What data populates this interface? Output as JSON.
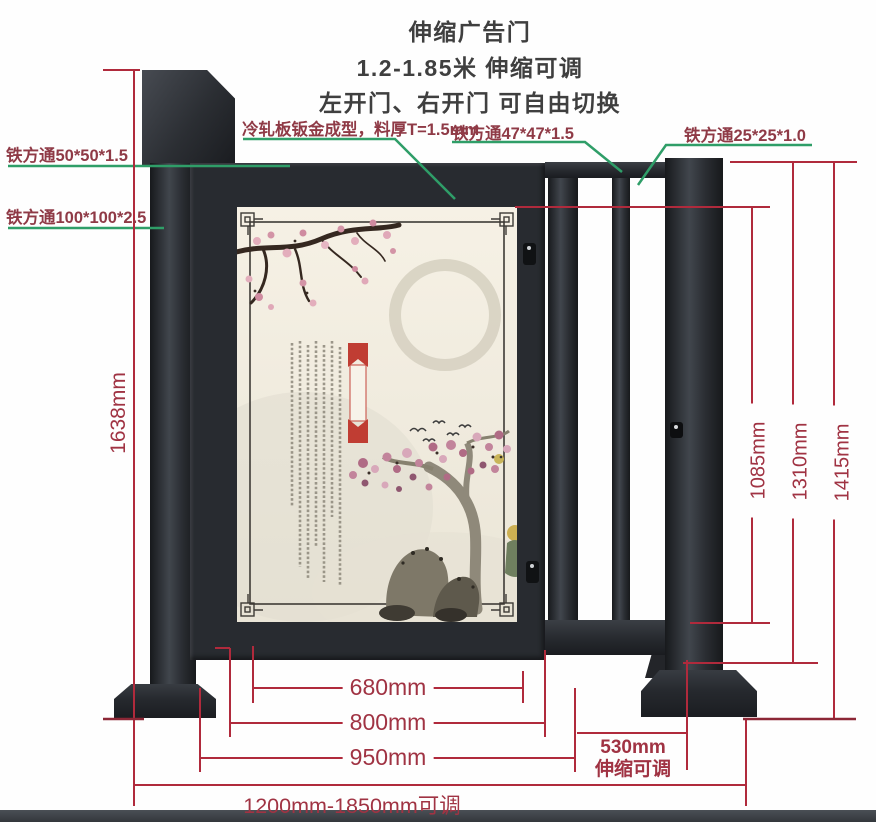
{
  "title": {
    "line1": "伸缩广告门",
    "line2": "1.2-1.85米 伸缩可调",
    "line3": "左开门、右开门 可自由切换"
  },
  "callouts": {
    "sheet_metal": "冷轧板钣金成型，料厚T=1.5mm",
    "tube_47": "铁方通47*47*1.5",
    "tube_25": "铁方通25*25*1.0",
    "tube_50": "铁方通50*50*1.5",
    "tube_100": "铁方通100*100*2.5"
  },
  "dimensions": {
    "total_height": "1638mm",
    "inner_height": "1085mm",
    "rail_height": "1310mm",
    "post_height": "1415mm",
    "panel_width": "680mm",
    "door_width": "800mm",
    "leaf_outer_width": "950mm",
    "retract_width": "530mm",
    "retract_note": "伸缩可调",
    "total_width": "1200mm-1850mm可调"
  },
  "artwork": {
    "big_char_1": "勤",
    "big_char_2": "奋",
    "banner_text": "天道酬勤"
  },
  "colors": {
    "annotation_red": "#b02a3c",
    "annotation_dark_red": "#8c2736",
    "leader_green": "#2f9e68",
    "label_maroon": "#8f3a46",
    "banner_red": "#c03d33",
    "metal_dark": "#26292e",
    "paper": "#f2edde"
  }
}
